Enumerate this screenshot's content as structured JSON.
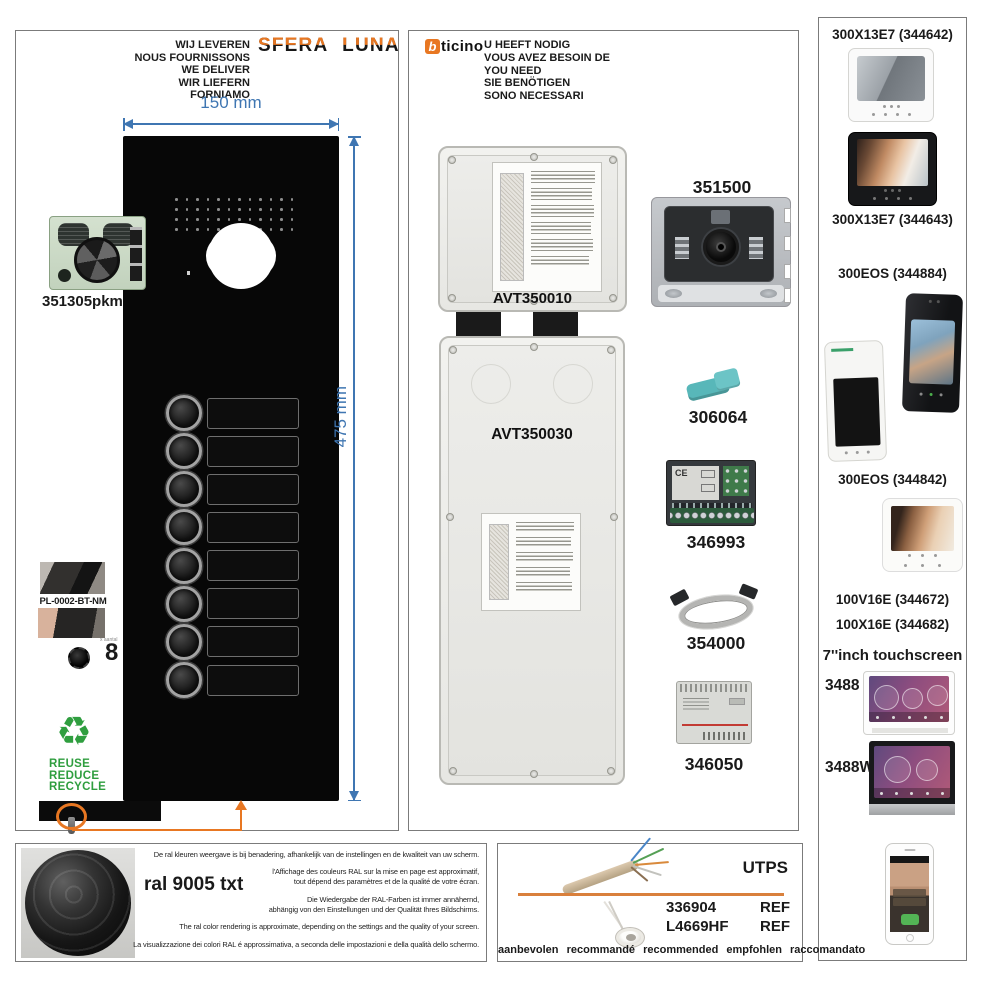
{
  "accent": {
    "orange": "#e87722",
    "blue": "#3f76b2",
    "green": "#2f9e3f"
  },
  "left_panel": {
    "deliver_lines": [
      "WIJ LEVEREN",
      "NOUS FOURNISSONS",
      "WE DELIVER",
      "WIR LIEFERN",
      "FORNIAMO"
    ],
    "brand_logo": "SFERA LUNA",
    "width_dim": "150 mm",
    "height_dim": "475 mm",
    "module_code": "351305pkm",
    "plate_code": "PL-0002-BT-NM",
    "button_count": 8,
    "button_count_label": "8",
    "button_count_caption": "x aantal",
    "recycle_icon": "♻",
    "recycle_lines": [
      "REUSE",
      "REDUCE",
      "RECYCLE"
    ]
  },
  "middle_panel": {
    "brand_b": "b",
    "brand_rest": "ticino",
    "need_lines": [
      "U HEEFT NODIG",
      "VOUS AVEZ BESOIN DE",
      "YOU NEED",
      "SIE BENÖTIGEN",
      "SONO NECESSARI"
    ],
    "flush_box_top": "AVT350010",
    "flush_box_bottom": "AVT350030",
    "camera_module": "351500",
    "release_key": "306064",
    "interface_module": "346993",
    "ribbon_cable": "354000",
    "power_supply": "346050",
    "ce_mark": "CE"
  },
  "right_panel": {
    "label_344642": "300X13E7 (344642)",
    "label_344643": "300X13E7 (344643)",
    "label_344884": "300EOS (344884)",
    "label_344842": "300EOS (344842)",
    "label_344672": "100V16E (344672)",
    "label_344682": "100X16E (344682)",
    "label_touch": "7''inch touchscreen",
    "label_3488": "3488",
    "label_3488w": "3488W"
  },
  "bottom_left": {
    "ral_label": "ral 9005 txt",
    "disclaimer_groups": [
      [
        "De ral kleuren weergave is bij benadering, afhankelijk van de instellingen en de kwaliteit van uw scherm."
      ],
      [
        "l'Affichage des couleurs RAL sur la mise en page est approximatif,",
        "tout dépend des paramètres et de la qualité de votre écran."
      ],
      [
        "Die Wiedergabe der RAL-Farben ist immer annähernd,",
        "abhängig von den Einstellungen und der Qualität Ihres Bildschirms."
      ],
      [
        "The ral color rendering is approximate, depending on the settings and the quality of your screen."
      ],
      [
        "La visualizzazione dei colori RAL é approssimativa, a seconda delle impostazioni e della qualità dello schermo."
      ]
    ]
  },
  "bottom_middle": {
    "utp_label": "UTPS",
    "ref1_code": "336904",
    "ref1_suffix": "REF",
    "ref2_code": "L4669HF",
    "ref2_suffix": "REF",
    "recommended_line": "aanbevolen  recommandé  recommended  empfohlen  raccomandato"
  }
}
